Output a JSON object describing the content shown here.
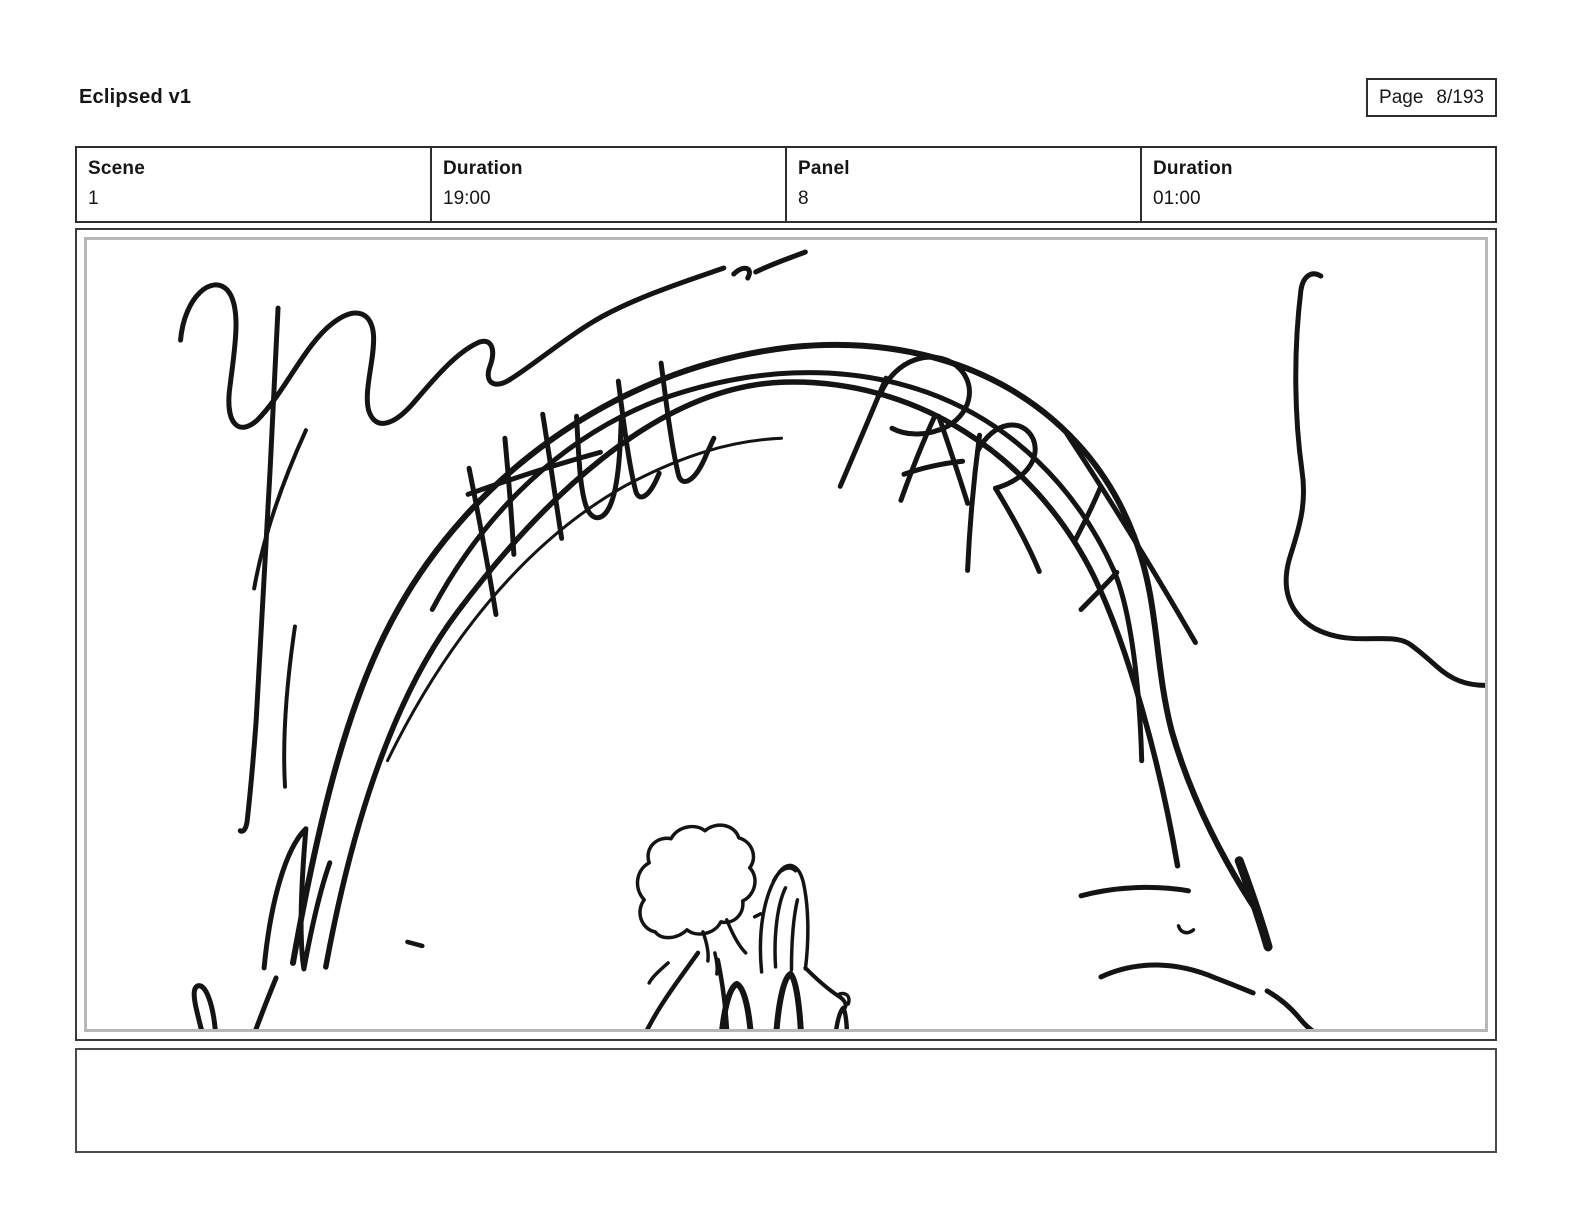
{
  "header": {
    "title": "Eclipsed v1",
    "page": {
      "label": "Page",
      "value": "8/193"
    }
  },
  "info_bar": {
    "columns": [
      {
        "label": "Scene",
        "value": "1"
      },
      {
        "label": "Duration",
        "value": "19:00"
      },
      {
        "label": "Panel",
        "value": "8"
      },
      {
        "label": "Duration",
        "value": "01:00"
      }
    ]
  },
  "storyboard_panel": {
    "sign_text": "HULL PARK",
    "description": "Rough black-ink storyboard sketch: curved park entrance archway with hand-scrawled sign reading HULL PARK, two small figures seen from behind walking under the arch, scribbled tree and bush lines at left and right, loose ground strokes lower right"
  },
  "notes": {
    "text": ""
  },
  "colors": {
    "ink": "#141414",
    "frame_dark": "#2e2e2e",
    "frame_light": "#b7b7b7",
    "background": "#ffffff"
  }
}
